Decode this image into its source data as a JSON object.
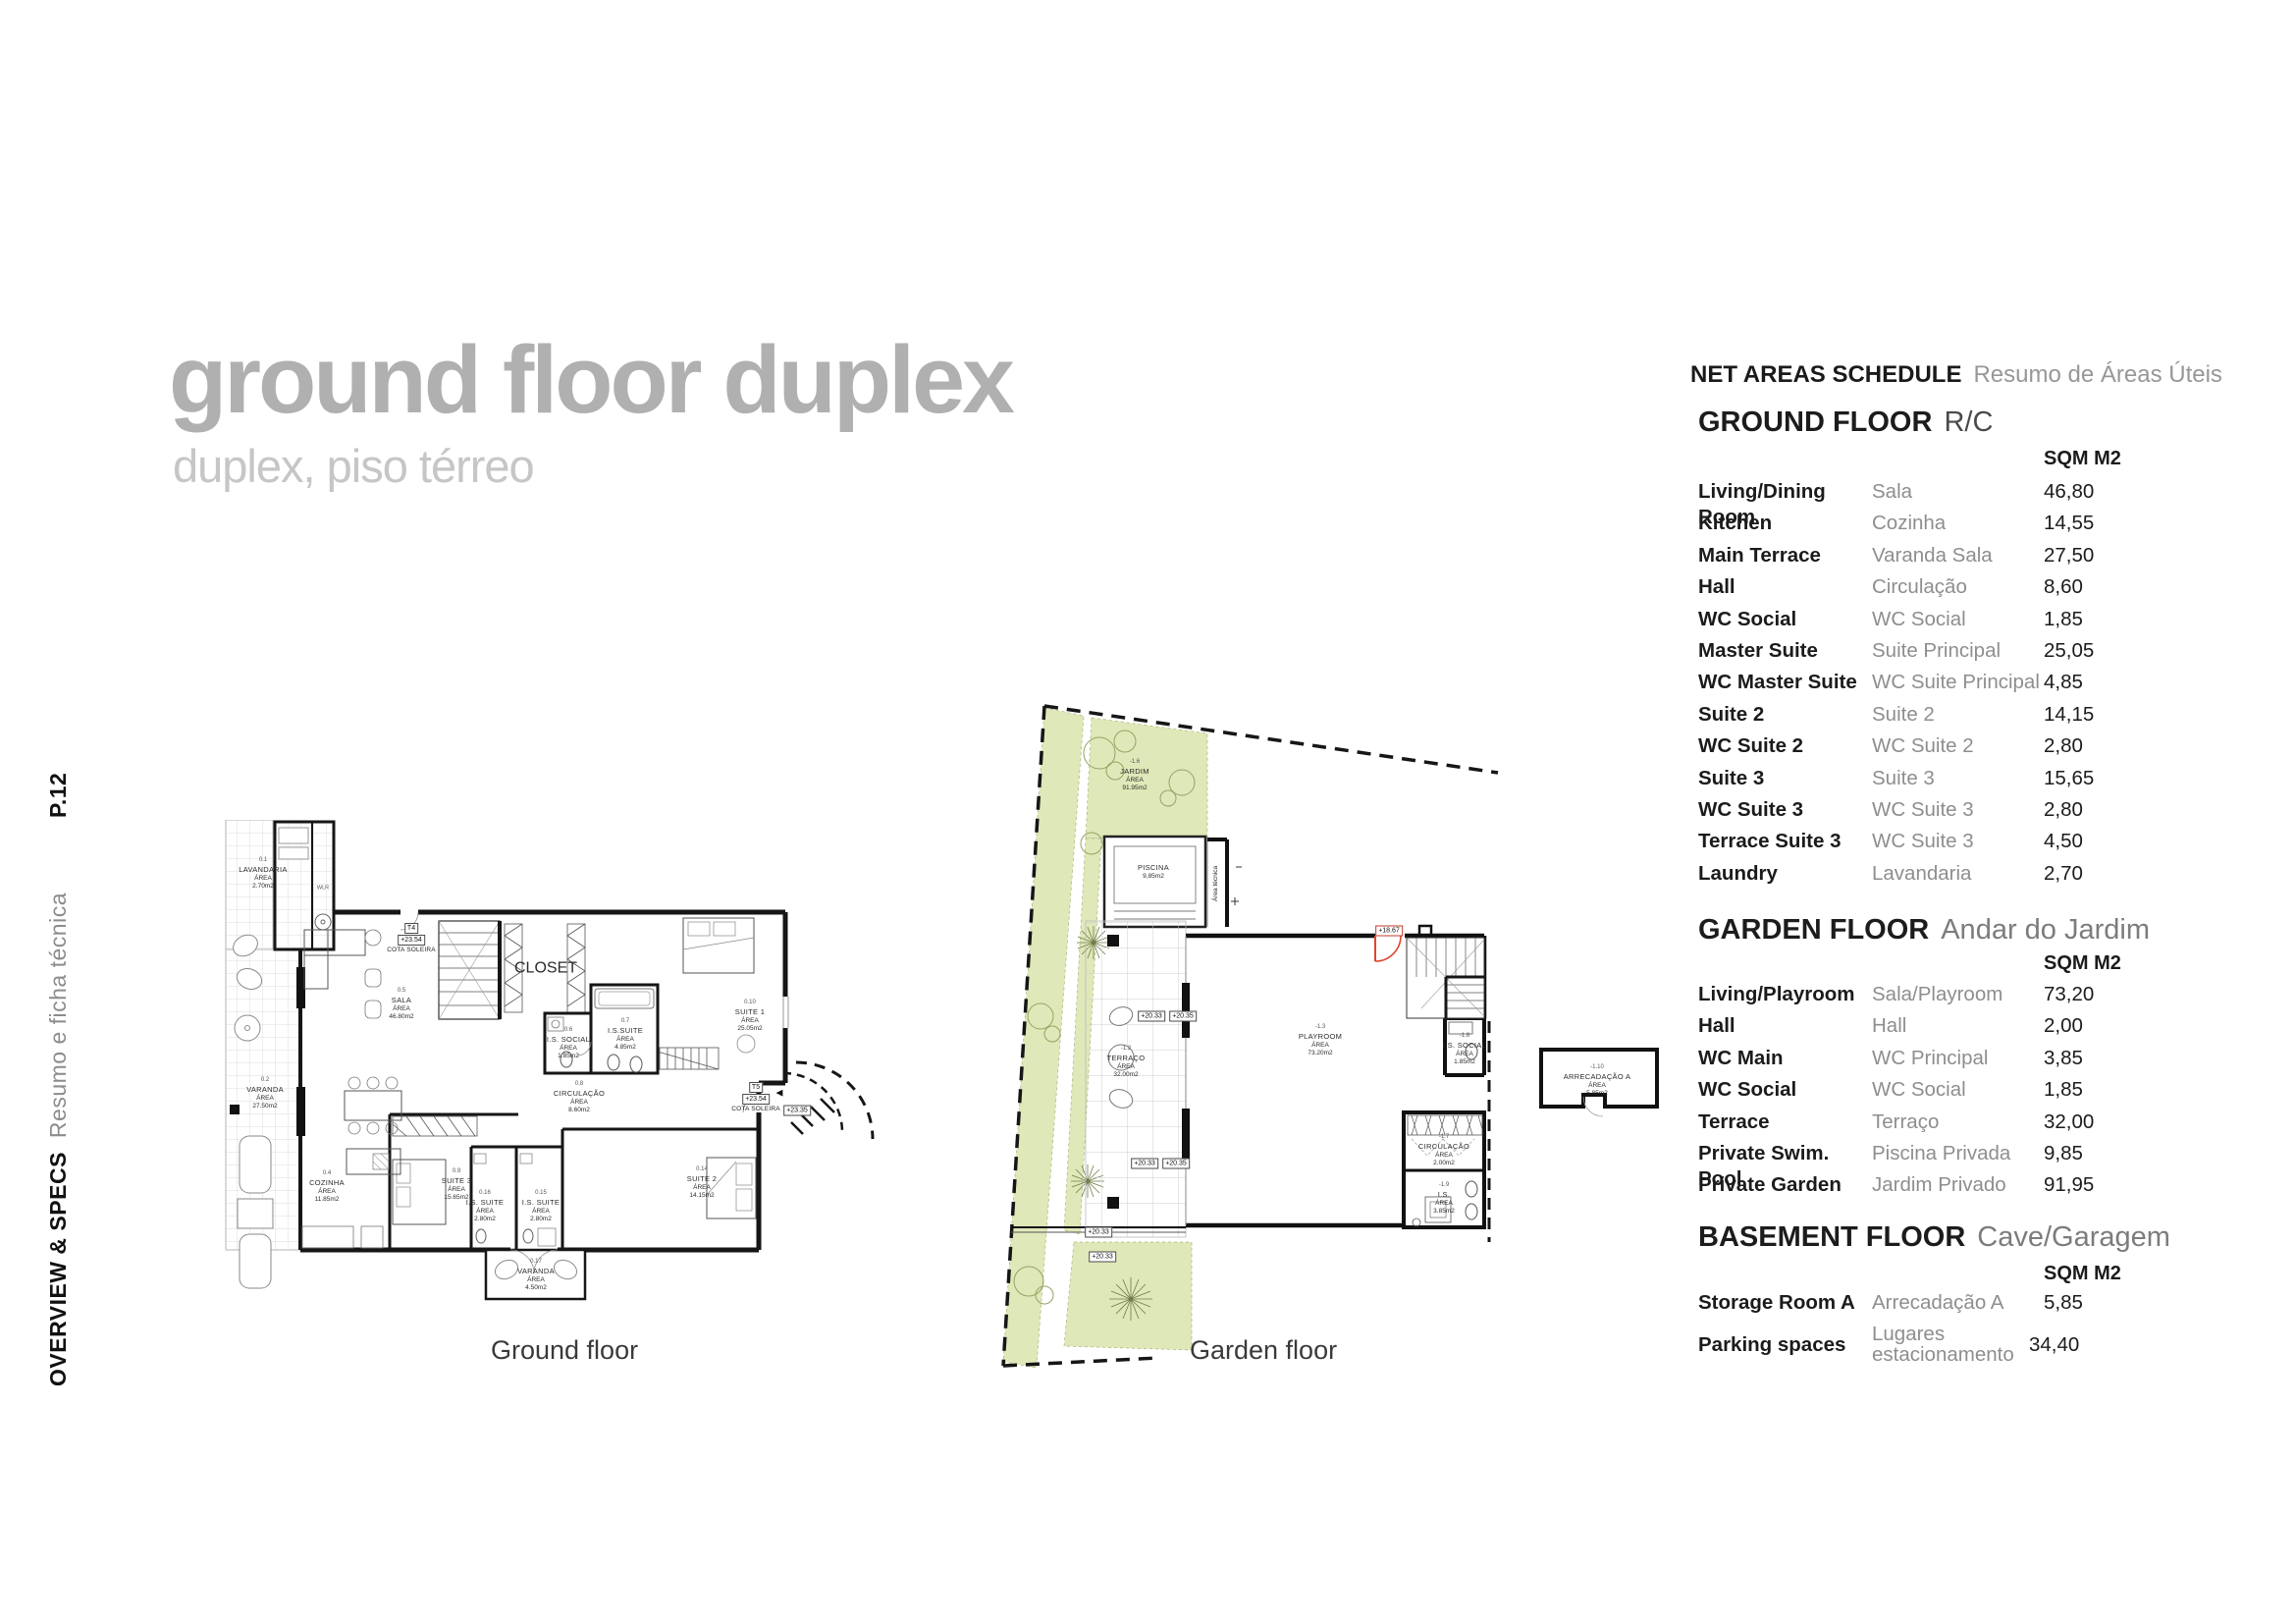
{
  "sidebar": {
    "page_number": "P.12",
    "section_en": "OVERVIEW & SPECS",
    "section_pt": "Resumo e ficha técnica"
  },
  "title": {
    "main": "ground floor duplex",
    "subtitle": "duplex, piso térreo"
  },
  "schedule": {
    "title_en": "NET AREAS SCHEDULE",
    "title_pt": "Resumo de Áreas Úteis",
    "sections": [
      {
        "name_en": "GROUND FLOOR",
        "name_pt": "R/C",
        "unit": "SQM M2",
        "rows": [
          {
            "en": "Living/Dining Room",
            "pt": "Sala",
            "value": "46,80"
          },
          {
            "en": "Kitchen",
            "pt": "Cozinha",
            "value": "14,55"
          },
          {
            "en": "Main Terrace",
            "pt": "Varanda Sala",
            "value": "27,50"
          },
          {
            "en": "Hall",
            "pt": "Circulação",
            "value": "8,60"
          },
          {
            "en": "WC Social",
            "pt": "WC Social",
            "value": "1,85"
          },
          {
            "en": "Master Suite",
            "pt": "Suite Principal",
            "value": "25,05"
          },
          {
            "en": "WC Master Suite",
            "pt": "WC Suite Principal",
            "value": "4,85"
          },
          {
            "en": "Suite 2",
            "pt": "Suite 2",
            "value": "14,15"
          },
          {
            "en": "WC Suite 2",
            "pt": "WC Suite 2",
            "value": "2,80"
          },
          {
            "en": "Suite 3",
            "pt": "Suite 3",
            "value": "15,65"
          },
          {
            "en": "WC Suite 3",
            "pt": "WC Suite 3",
            "value": "2,80"
          },
          {
            "en": "Terrace Suite 3",
            "pt": "WC Suite 3",
            "value": "4,50"
          },
          {
            "en": "Laundry",
            "pt": "Lavandaria",
            "value": "2,70"
          }
        ]
      },
      {
        "name_en": "GARDEN FLOOR",
        "name_pt": "Andar do Jardim",
        "unit": "SQM M2",
        "rows": [
          {
            "en": "Living/Playroom",
            "pt": "Sala/Playroom",
            "value": "73,20"
          },
          {
            "en": "Hall",
            "pt": "Hall",
            "value": "2,00"
          },
          {
            "en": "WC Main",
            "pt": "WC Principal",
            "value": "3,85"
          },
          {
            "en": "WC Social",
            "pt": "WC Social",
            "value": "1,85"
          },
          {
            "en": "Terrace",
            "pt": "Terraço",
            "value": "32,00"
          },
          {
            "en": "Private Swim. Pool",
            "pt": "Piscina Privada",
            "value": "9,85"
          },
          {
            "en": "Private Garden",
            "pt": "Jardim Privado",
            "value": "91,95"
          }
        ]
      },
      {
        "name_en": "BASEMENT FLOOR",
        "name_pt": "Cave/Garagem",
        "unit": "SQM M2",
        "rows": [
          {
            "en": "Storage Room A",
            "pt": "Arrecadação A",
            "value": "5,85"
          },
          {
            "en": "Parking spaces",
            "pt": "Lugares estacionamento",
            "value": "34,40"
          }
        ]
      }
    ]
  },
  "plans": {
    "ground": {
      "caption": "Ground floor",
      "rooms": {
        "lavandaria": {
          "code": "0.1",
          "name": "LAVANDARIA",
          "area_label": "ÁREA",
          "area": "2.70m2"
        },
        "varanda": {
          "code": "0.2",
          "name": "VARANDA",
          "area_label": "ÁREA",
          "area": "27.50m2"
        },
        "sala": {
          "code": "0.5",
          "name": "SALA",
          "area_label": "ÁREA",
          "area": "46.80m2"
        },
        "cozinha": {
          "code": "0.4",
          "name": "COZINHA",
          "area_label": "ÁREA",
          "area": "11.85m2"
        },
        "is_social": {
          "code": "0.6",
          "name": "I.S. SOCIAL",
          "area_label": "ÁREA",
          "area": "1.85m2"
        },
        "is_suite": {
          "code": "0.7",
          "name": "I.S.SUITE",
          "area_label": "ÁREA",
          "area": "4.85m2"
        },
        "circulacao": {
          "code": "0.8",
          "name": "CIRCULAÇÃO",
          "area_label": "ÁREA",
          "area": "8.60m2"
        },
        "suite1": {
          "code": "0.10",
          "name": "SUITE 1",
          "area_label": "ÁREA",
          "area": "25.05m2"
        },
        "suite2": {
          "code": "0.14",
          "name": "SUITE 2",
          "area_label": "ÁREA",
          "area": "14.15m2"
        },
        "suite3": {
          "code": "0.9",
          "name": "SUITE 3",
          "area_label": "ÁREA",
          "area": "15.65m2"
        },
        "is15": {
          "code": "0.15",
          "name": "I.S. SUITE",
          "area_label": "ÁREA",
          "area": "2.80m2"
        },
        "is16": {
          "code": "0.16",
          "name": "I.S. SUITE",
          "area_label": "ÁREA",
          "area": "2.80m2"
        },
        "varanda17": {
          "code": "0.17",
          "name": "VARANDA",
          "area_label": "ÁREA",
          "area": "4.50m2"
        },
        "closet": "CLOSET",
        "wlr": "WLR"
      },
      "markers": {
        "t4": {
          "label": "T4",
          "elev": "+23.54",
          "note": "COTA SOLEIRA"
        },
        "t5": {
          "label": "T5",
          "elev": "+23.54",
          "note": "COTA SOLEIRA",
          "elev2": "+23.35",
          "triangle": "◀"
        }
      }
    },
    "garden": {
      "caption": "Garden floor",
      "rooms": {
        "jardim": {
          "code": "-1.6",
          "name": "JARDIM",
          "area_label": "ÁREA",
          "area": "91.95m2"
        },
        "piscina": {
          "name": "PISCINA",
          "area": "9,85m2"
        },
        "area_tecnica": "Área técnica",
        "terraco": {
          "code": "-1.2",
          "name": "TERRAÇO",
          "area_label": "ÁREA",
          "area": "32.00m2"
        },
        "playroom": {
          "code": "-1.3",
          "name": "PLAYROOM",
          "area_label": "ÁREA",
          "area": "73.20m2"
        },
        "is_social": {
          "code": "-1.8",
          "name": "I.S. SOCIAL",
          "area_label": "ÁREA",
          "area": "1.85m2"
        },
        "circulacao": {
          "code": "-1.7",
          "name": "CIRCULAÇÃO",
          "area_label": "ÁREA",
          "area": "2.00m2"
        },
        "is_main": {
          "code": "-1.9",
          "name": "I.S.",
          "area_label": "ÁREA",
          "area": "3.85m2"
        },
        "arrecadacao": {
          "code": "-1.10",
          "name": "ARRECADAÇÃO A",
          "area_label": "ÁREA",
          "area": "5.85m2"
        }
      },
      "markers": {
        "red": "+18.67",
        "g1": "+20.33",
        "g2": "+20.35",
        "g3": "+20.33",
        "g4": "+20.35",
        "g5": "+20.33",
        "g6": "+20.33"
      }
    }
  },
  "colors": {
    "accent_green": "#dfe8b8",
    "door_red": "#e0452b",
    "title_gray": "#b0b0b0"
  }
}
